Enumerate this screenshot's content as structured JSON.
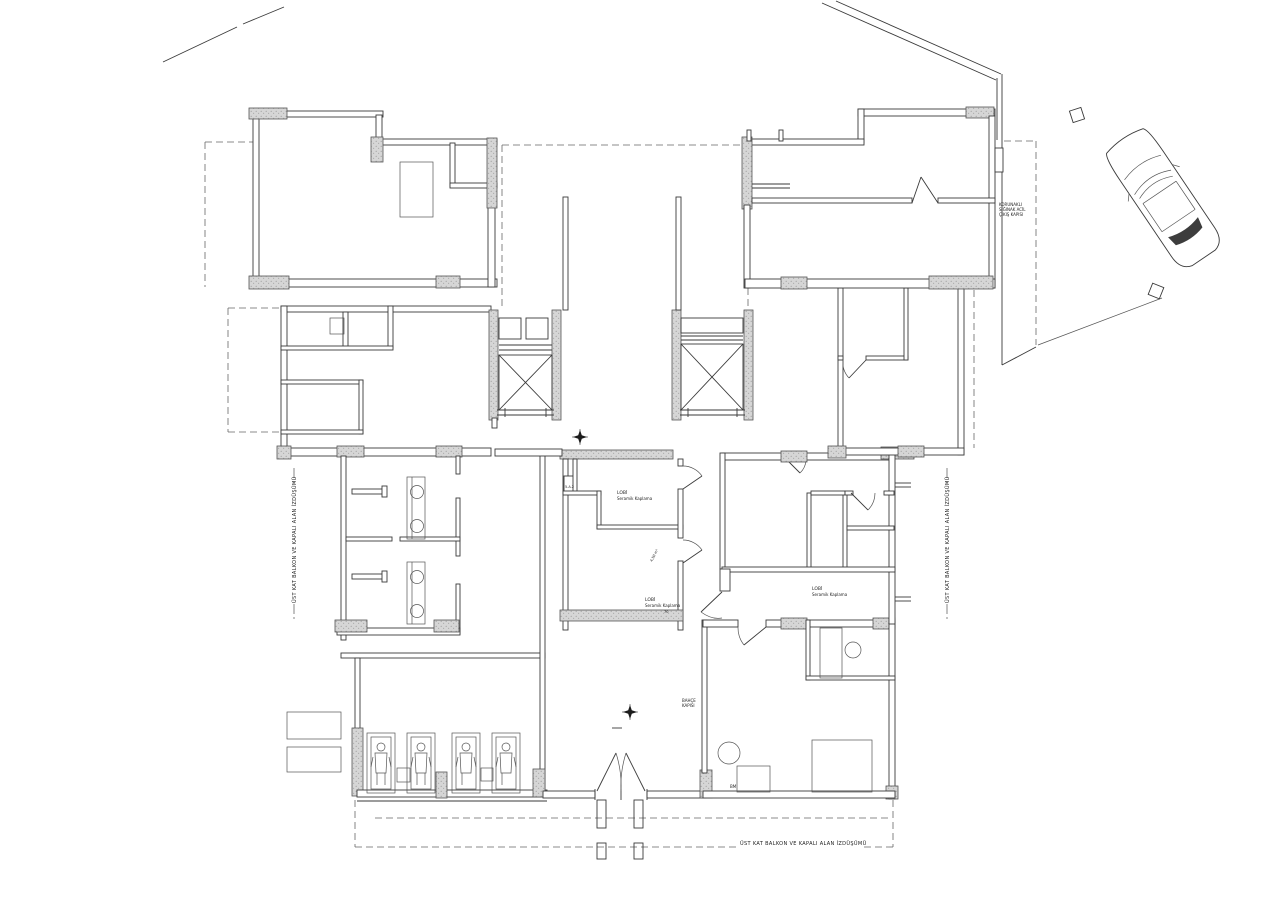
{
  "drawing": {
    "type": "architectural-floor-plan",
    "background": "#ffffff",
    "line_color": "#3a3a3a",
    "hatch_color": "#d6d6d6"
  },
  "labels": {
    "shelter_exit_line1": "KORUNAKLI",
    "shelter_exit_line2": "SIĞINAK ACİL",
    "shelter_exit_line3": "ÇIKIŞ KAPISI",
    "lobby_upper_name": "LOBİ",
    "lobby_upper_finish": "Seramik Kaplama",
    "lobby_lower_name": "LOBİ",
    "lobby_lower_finish": "Seramik Kaplama",
    "lobby_right_name": "LOBİ",
    "lobby_right_finish": "Seramik Kaplama",
    "garden_door_line1": "BAHÇE",
    "garden_door_line2": "KAPISI",
    "bm": "BM",
    "shaft_tag": "5.A.2",
    "area_note": "4,50 m²",
    "dim_note": "70",
    "projection_left": "ÜST KAT BALKON VE KAPALI ALAN İZDÜŞÜMÜ",
    "projection_right": "ÜST KAT BALKON VE KAPALI ALAN İZDÜŞÜMÜ",
    "projection_bottom": "ÜST KAT BALKON VE KAPALI ALAN İZDÜŞÜMÜ"
  }
}
